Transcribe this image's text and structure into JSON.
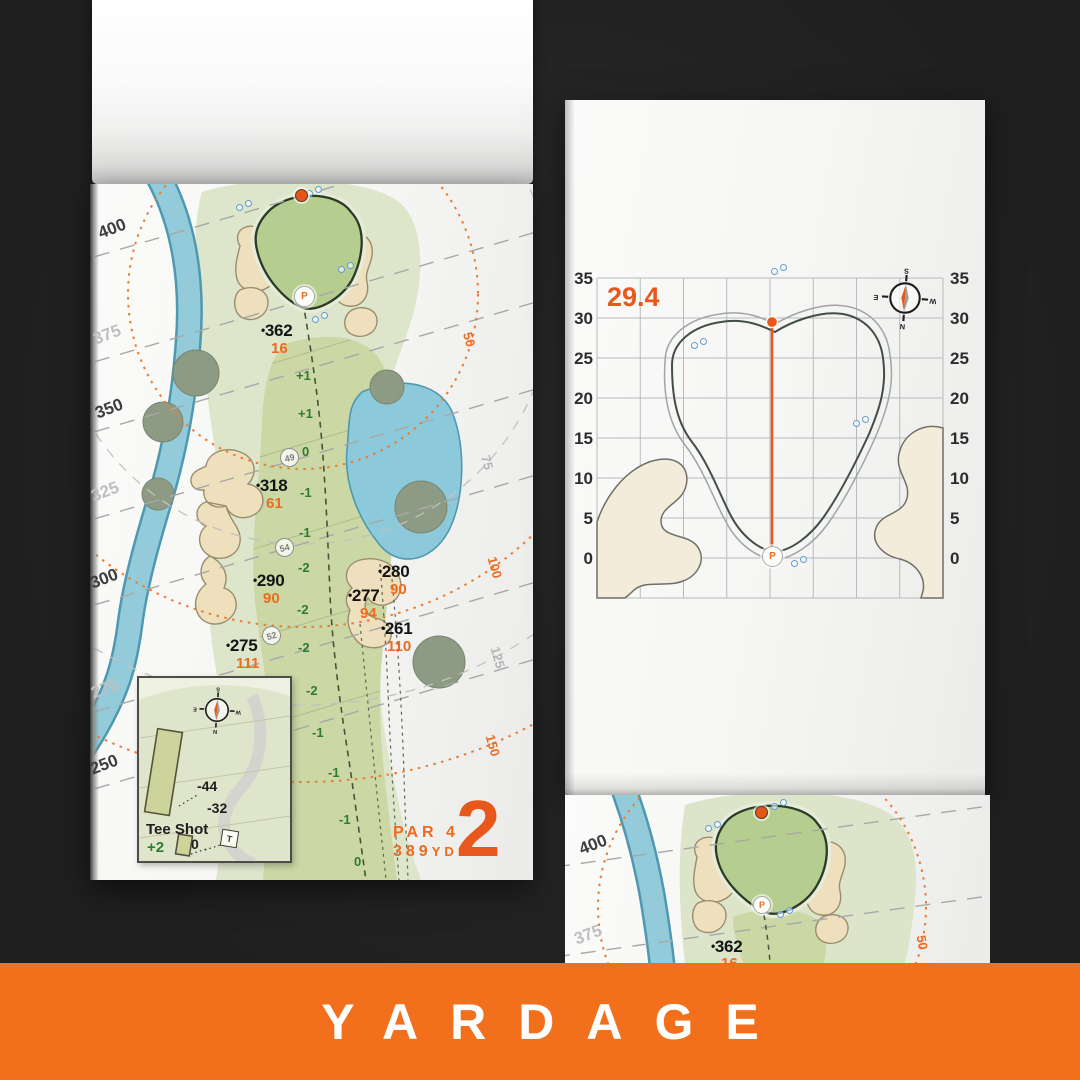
{
  "colors": {
    "accent_orange": "#ED6A1F",
    "hole_number_orange": "#E8581C",
    "banner_orange": "#F2701C",
    "slope_green": "#2F7A33",
    "water_blue": "#8ECADB",
    "sand": "#F0E6CC",
    "fairway_green": "#CBD7A4",
    "putting_green": "#B5CD8E",
    "background_dark": "#242424"
  },
  "banner": {
    "label": "YARDAGE"
  },
  "compass": {
    "n": "N",
    "e": "E",
    "s": "S",
    "w": "W"
  },
  "hole_page": {
    "bullet": "•",
    "rings": [
      "400",
      "375",
      "350",
      "325",
      "300",
      "275",
      "250"
    ],
    "arcs": [
      "50",
      "75",
      "100",
      "125",
      "150"
    ],
    "points": [
      {
        "dist": "362",
        "carry": "16"
      },
      {
        "dist": "318",
        "carry": "61"
      },
      {
        "dist": "290",
        "carry": "90"
      },
      {
        "dist": "280",
        "carry": "90"
      },
      {
        "dist": "277",
        "carry": "94"
      },
      {
        "dist": "261",
        "carry": "110"
      },
      {
        "dist": "275",
        "carry": "111"
      }
    ],
    "slopes": [
      "+1",
      "+1",
      "0",
      "-1",
      "-1",
      "-2",
      "-2",
      "-2",
      "-2",
      "-1",
      "-1",
      "-1",
      "0"
    ],
    "waypoints": [
      "49",
      "54",
      "52"
    ],
    "tee_inset": {
      "title": "Tee Shot",
      "score": "+2",
      "back": "-44",
      "front": "-32",
      "zero": "0",
      "marker": "T"
    },
    "par": "PAR 4",
    "yards": "389",
    "unit": "YD",
    "hole": "2",
    "pin": "P"
  },
  "green_page": {
    "depth": "29.4",
    "ticks": [
      "35",
      "30",
      "25",
      "20",
      "15",
      "10",
      "5",
      "0"
    ],
    "pin": "P"
  },
  "next_page": {
    "bullet": "•",
    "rings": [
      "400",
      "375"
    ],
    "point": {
      "dist": "362",
      "carry": "16"
    },
    "arc": "50",
    "pin": "P"
  }
}
